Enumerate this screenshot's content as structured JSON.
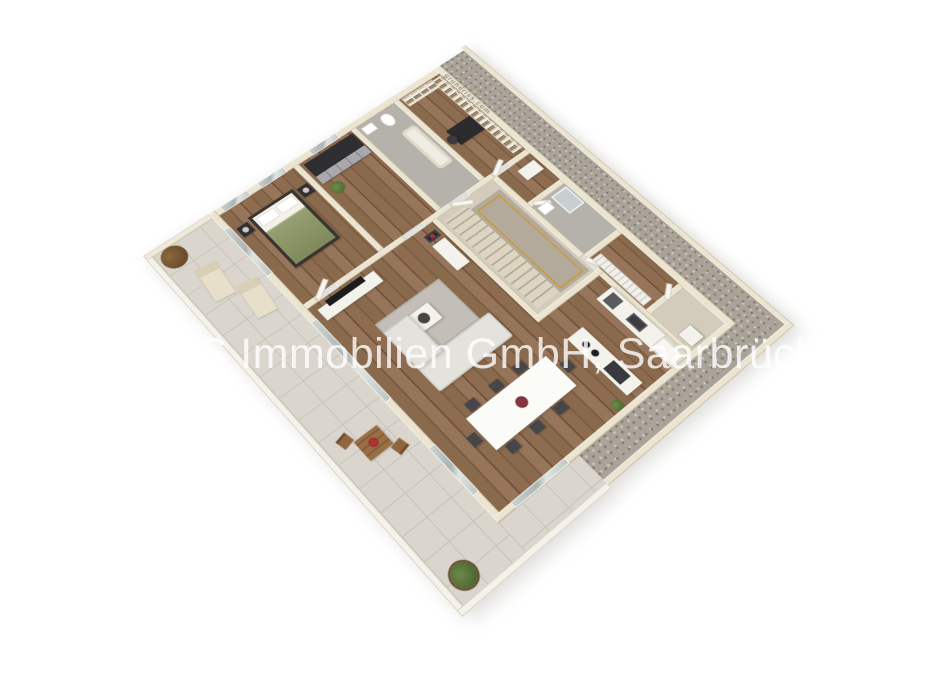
{
  "image": {
    "width": 933,
    "height": 700,
    "description": "3D aerial rendering of an apartment floor plan, rotated diamond orientation on white background"
  },
  "watermark": {
    "text": "LBS Immobilien GmbH, Saarbrücken ©"
  },
  "wall_branding": {
    "text": "grundriss.com",
    "location": "top of north-east exterior wall"
  },
  "scene": {
    "type": "3d-floor-plan-render",
    "rooms": [
      {
        "name": "bedroom",
        "floor": "wood",
        "furniture": [
          "double-bed-green-duvet",
          "nightstand-left",
          "nightstand-right",
          "table-lamps"
        ]
      },
      {
        "name": "dressing-room",
        "floor": "wood",
        "furniture": [
          "dark-wardrobe-row",
          "plant"
        ]
      },
      {
        "name": "bathroom-1",
        "floor": "grey-tile",
        "furniture": [
          "toilet",
          "bathtub",
          "sink"
        ]
      },
      {
        "name": "office",
        "floor": "wood",
        "furniture": [
          "bookshelf-wall",
          "dark-desk",
          "office-chair"
        ]
      },
      {
        "name": "living-room",
        "floor": "wood",
        "furniture": [
          "corner-sofa",
          "rug",
          "coffee-table",
          "tv-lowboard",
          "tv",
          "cabinet",
          "wall-art"
        ]
      },
      {
        "name": "stairwell",
        "floor": "beige",
        "furniture": [
          "staircase",
          "gold-railing"
        ]
      },
      {
        "name": "hallway",
        "floor": "wood",
        "furniture": [
          "white-dresser",
          "slatted-shelf",
          "doors"
        ]
      },
      {
        "name": "bathroom-2",
        "floor": "grey-tile",
        "furniture": [
          "shower",
          "sink"
        ]
      },
      {
        "name": "storage-room",
        "floor": "beige",
        "furniture": [
          "white-appliance"
        ]
      },
      {
        "name": "dining-kitchen",
        "floor": "wood",
        "furniture": [
          "white-dining-table",
          "eight-dark-chairs",
          "red-centerpiece",
          "kitchen-island-with-cooktop",
          "oven-column",
          "counter-with-sink",
          "fridge",
          "shrub"
        ]
      }
    ],
    "outdoor": [
      {
        "name": "terrace-balcony",
        "floor": "large-tiles",
        "items": [
          "two-sun-loungers",
          "round-brown-plant",
          "wooden-bistro-table",
          "two-wooden-chairs",
          "red-flower-pot",
          "potted-plant-south-corner"
        ]
      },
      {
        "name": "gravel-strip",
        "location": "east-and-south-perimeter"
      }
    ]
  },
  "theme": {
    "bg": "#ffffff",
    "wall": "#ebe4d0",
    "tile": "#dbd6cd",
    "gravel": "#a9a399",
    "greyfloor": "#b5b1ab",
    "whitefurn": "#f4f2ec",
    "darkfurn": "#2f2f33",
    "gold": "#c79a3d",
    "watermark": "rgba(255,255,255,0.8)"
  }
}
